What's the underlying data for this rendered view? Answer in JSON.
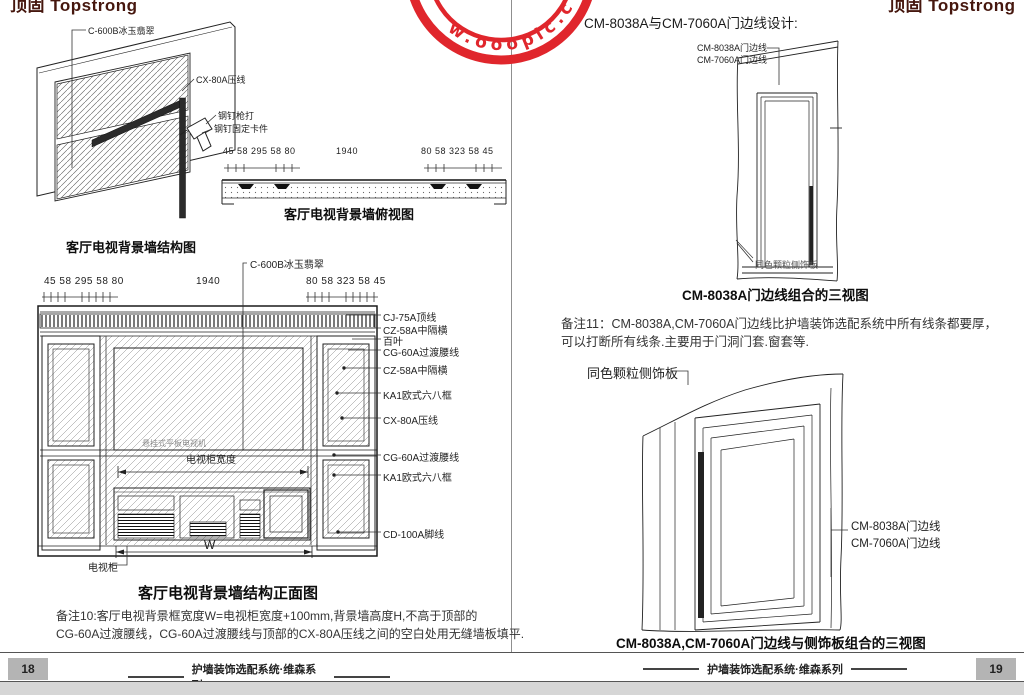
{
  "logo_text": "顶固 Topstrong",
  "watermark": {
    "text": "w.ooopic.c",
    "color": "#e0262c"
  },
  "footer": {
    "series_title": "护墙装饰选配系统·维森系列",
    "page_left": "18",
    "page_right": "19"
  },
  "left_page": {
    "iso": {
      "panel_label": "C-600B冰玉翡翠",
      "trim_label": "CX-80A压线",
      "nail_label1": "钢钉枪打",
      "nail_label2": "钢钉固定卡件",
      "caption": "客厅电视背景墙结构图"
    },
    "dims": {
      "left": "45 58 295 58 80",
      "center": "1940",
      "right": "80 58 323 58 45"
    },
    "top_view": {
      "caption": "客厅电视背景墙俯视图"
    },
    "front_view": {
      "top_label": "C-600B冰玉翡翠",
      "side_labels": [
        "CJ-75A顶线",
        "CZ-58A中隔横",
        "百叶",
        "CG-60A过渡腰线",
        "CZ-58A中隔横",
        "KA1欧式六八框",
        "CX-80A压线",
        "CG-60A过渡腰线",
        "KA1欧式六八框",
        "CD-100A脚线"
      ],
      "tv_area_label": "悬挂式平板电视机",
      "tv_width_label": "电视柜宽度",
      "width_symbol": "W",
      "cabinet_label": "电视柜",
      "caption": "客厅电视背景墙结构正面图"
    },
    "note": {
      "line1": "备注10:客厅电视背景框宽度W=电视柜宽度+100mm,背景墙高度H,不高于顶部的",
      "line2": "CG-60A过渡腰线，CG-60A过渡腰线与顶部的CX-80A压线之间的空白处用无缝墙板填平."
    }
  },
  "right_page": {
    "header_bullet": "●",
    "header": "CM-8038A与CM-7060A门边线设计:",
    "diagram1": {
      "edge_label1": "CM-8038A门边线",
      "edge_label2": "CM-7060A门边线",
      "side_panel_label": "同色颗粒侧饰板",
      "caption": "CM-8038A门边线组合的三视图"
    },
    "note": {
      "line1": "备注11：CM-8038A,CM-7060A门边线比护墙装饰选配系统中所有线条都要厚，",
      "line2": "可以打断所有线条.主要用于门洞门套.窗套等."
    },
    "diagram2": {
      "side_panel_label": "同色颗粒侧饰板",
      "edge_label1": "CM-8038A门边线",
      "edge_label2": "CM-7060A门边线",
      "caption": "CM-8038A,CM-7060A门边线与侧饰板组合的三视图"
    }
  }
}
